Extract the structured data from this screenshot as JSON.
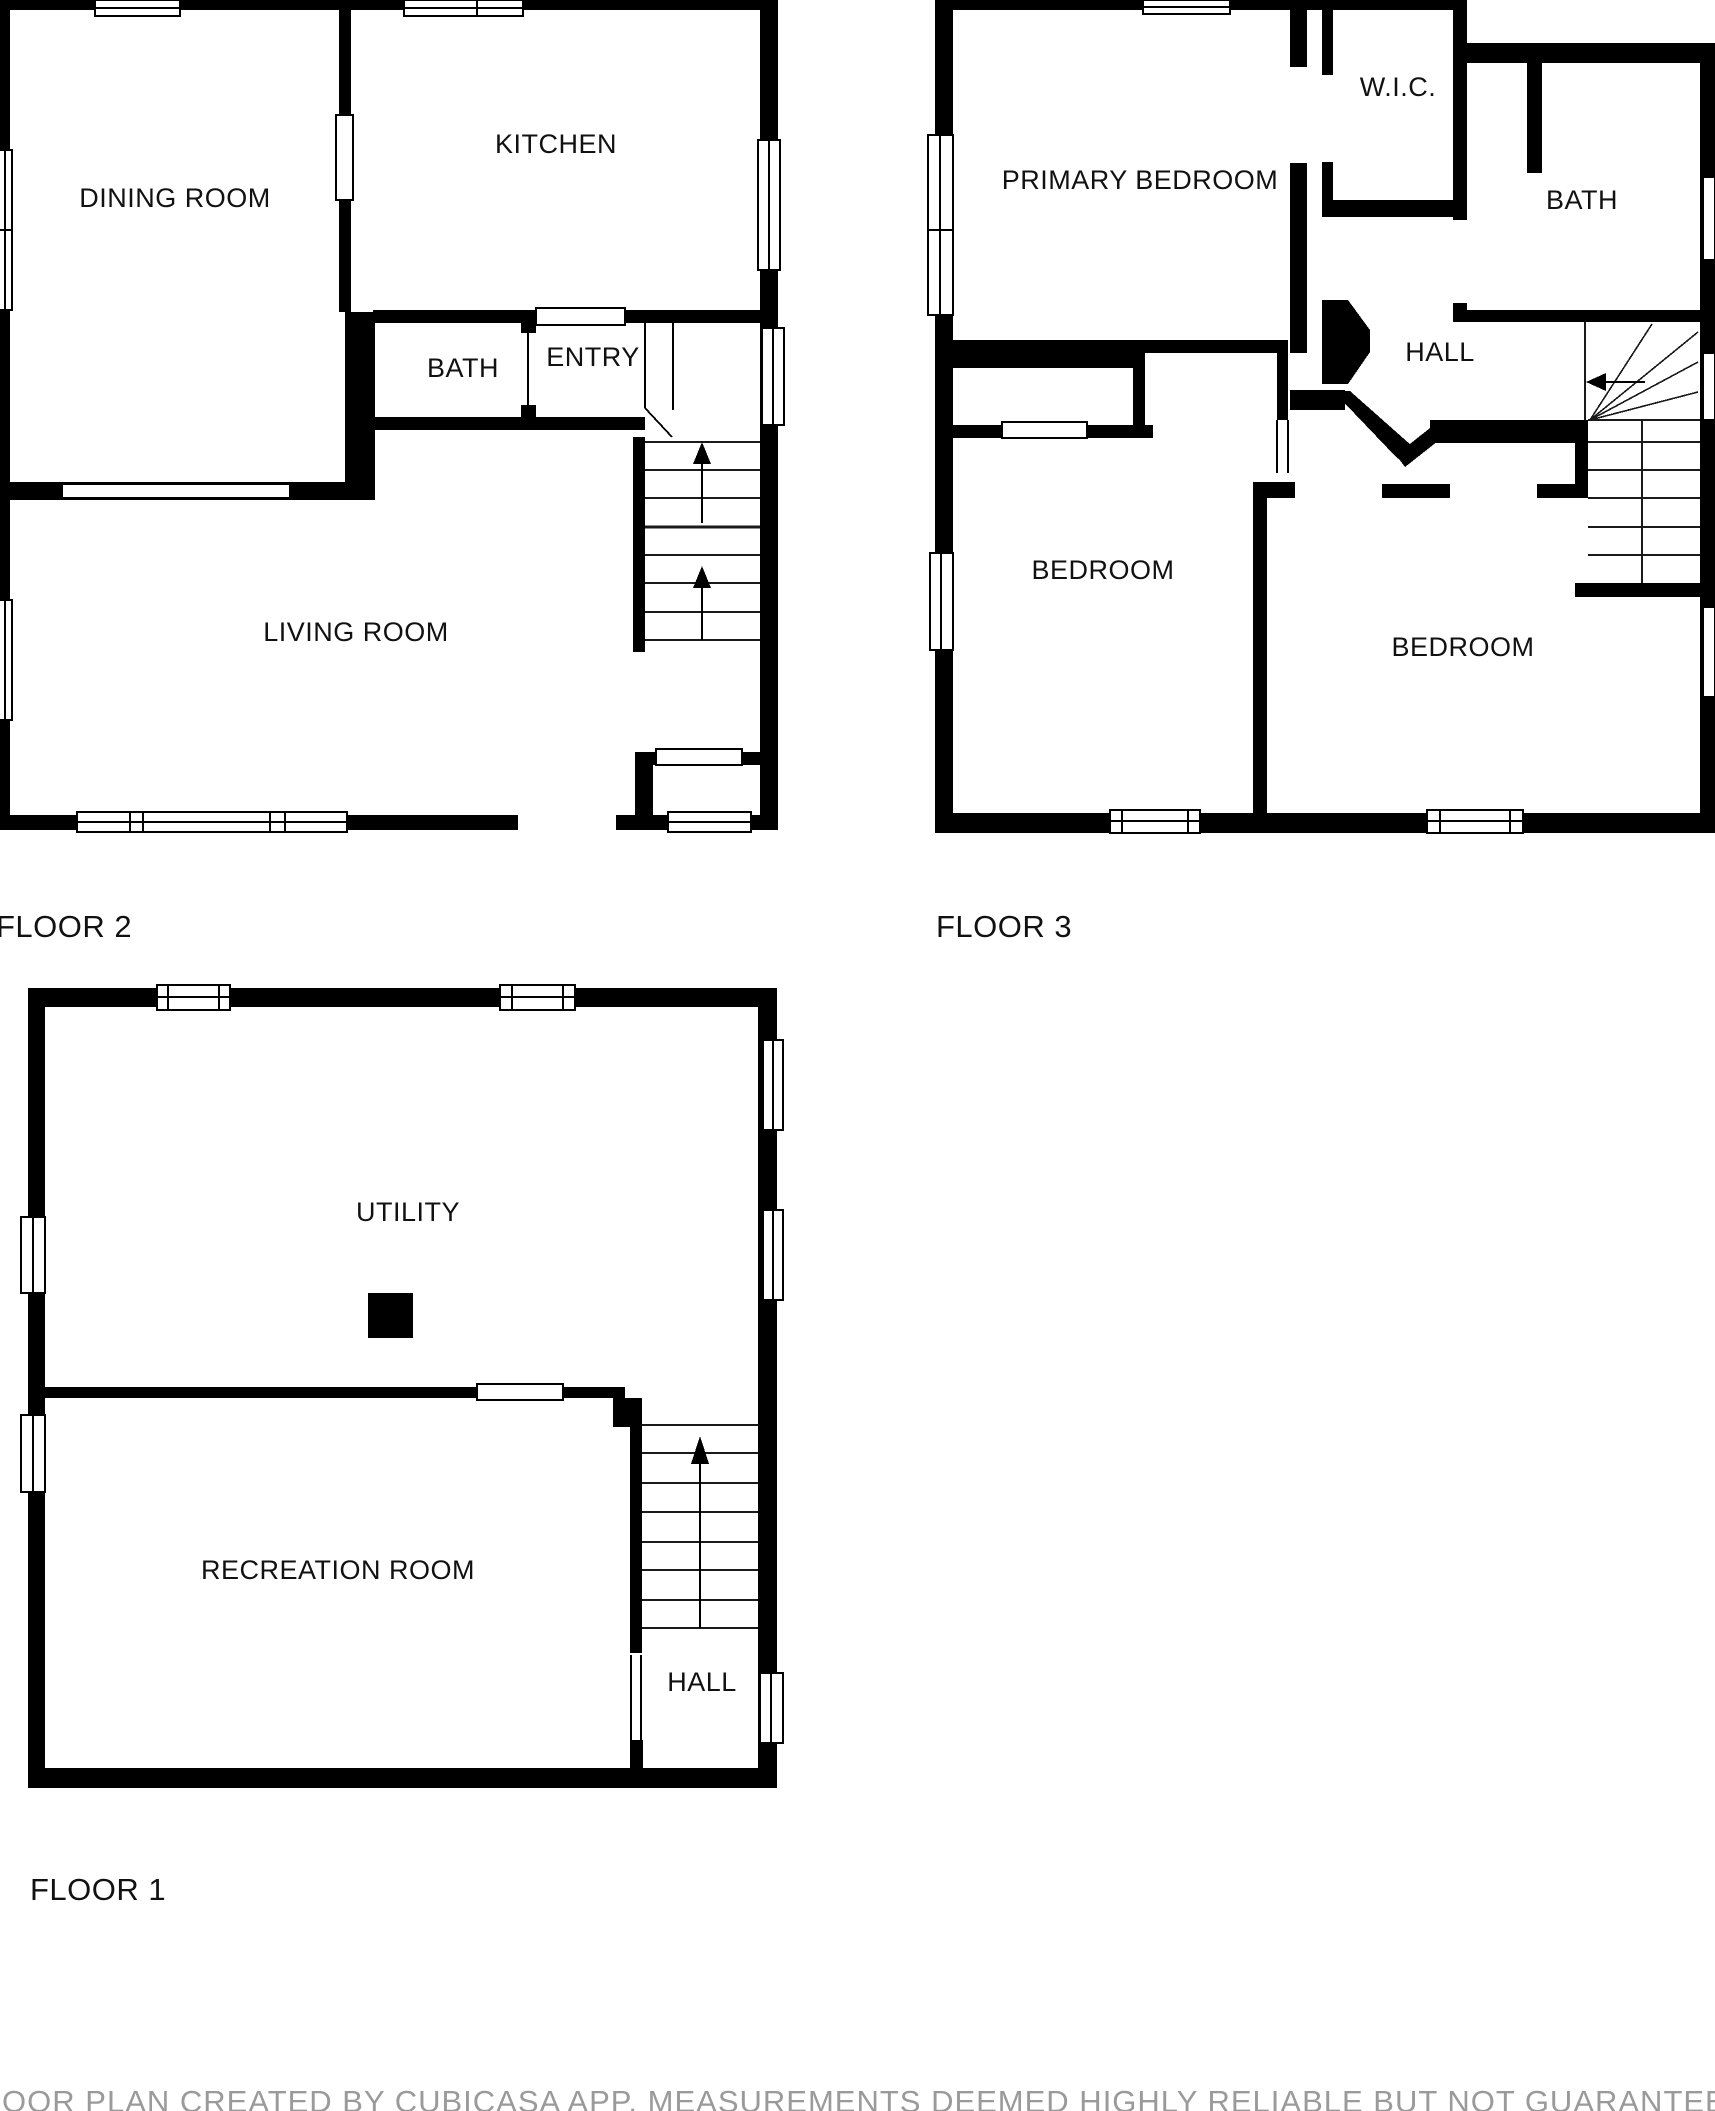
{
  "page": {
    "background": "#ffffff",
    "wall_color": "#000000",
    "disclaimer": "FLOOR PLAN CREATED BY CUBICASA APP. MEASUREMENTS DEEMED HIGHLY RELIABLE BUT NOT GUARANTEED",
    "disclaimer_color": "#9a9a9a"
  },
  "floors": [
    {
      "label": "FLOOR 2",
      "rooms": {
        "dining": "DINING ROOM",
        "kitchen": "KITCHEN",
        "bath": "BATH",
        "entry": "ENTRY",
        "living": "LIVING ROOM"
      }
    },
    {
      "label": "FLOOR 3",
      "rooms": {
        "primary": "PRIMARY BEDROOM",
        "wic": "W.I.C.",
        "bath": "BATH",
        "hall": "HALL",
        "bedroom1": "BEDROOM",
        "bedroom2": "BEDROOM"
      }
    },
    {
      "label": "FLOOR 1",
      "rooms": {
        "utility": "UTILITY",
        "rec": "RECREATION ROOM",
        "hall": "HALL"
      }
    }
  ]
}
